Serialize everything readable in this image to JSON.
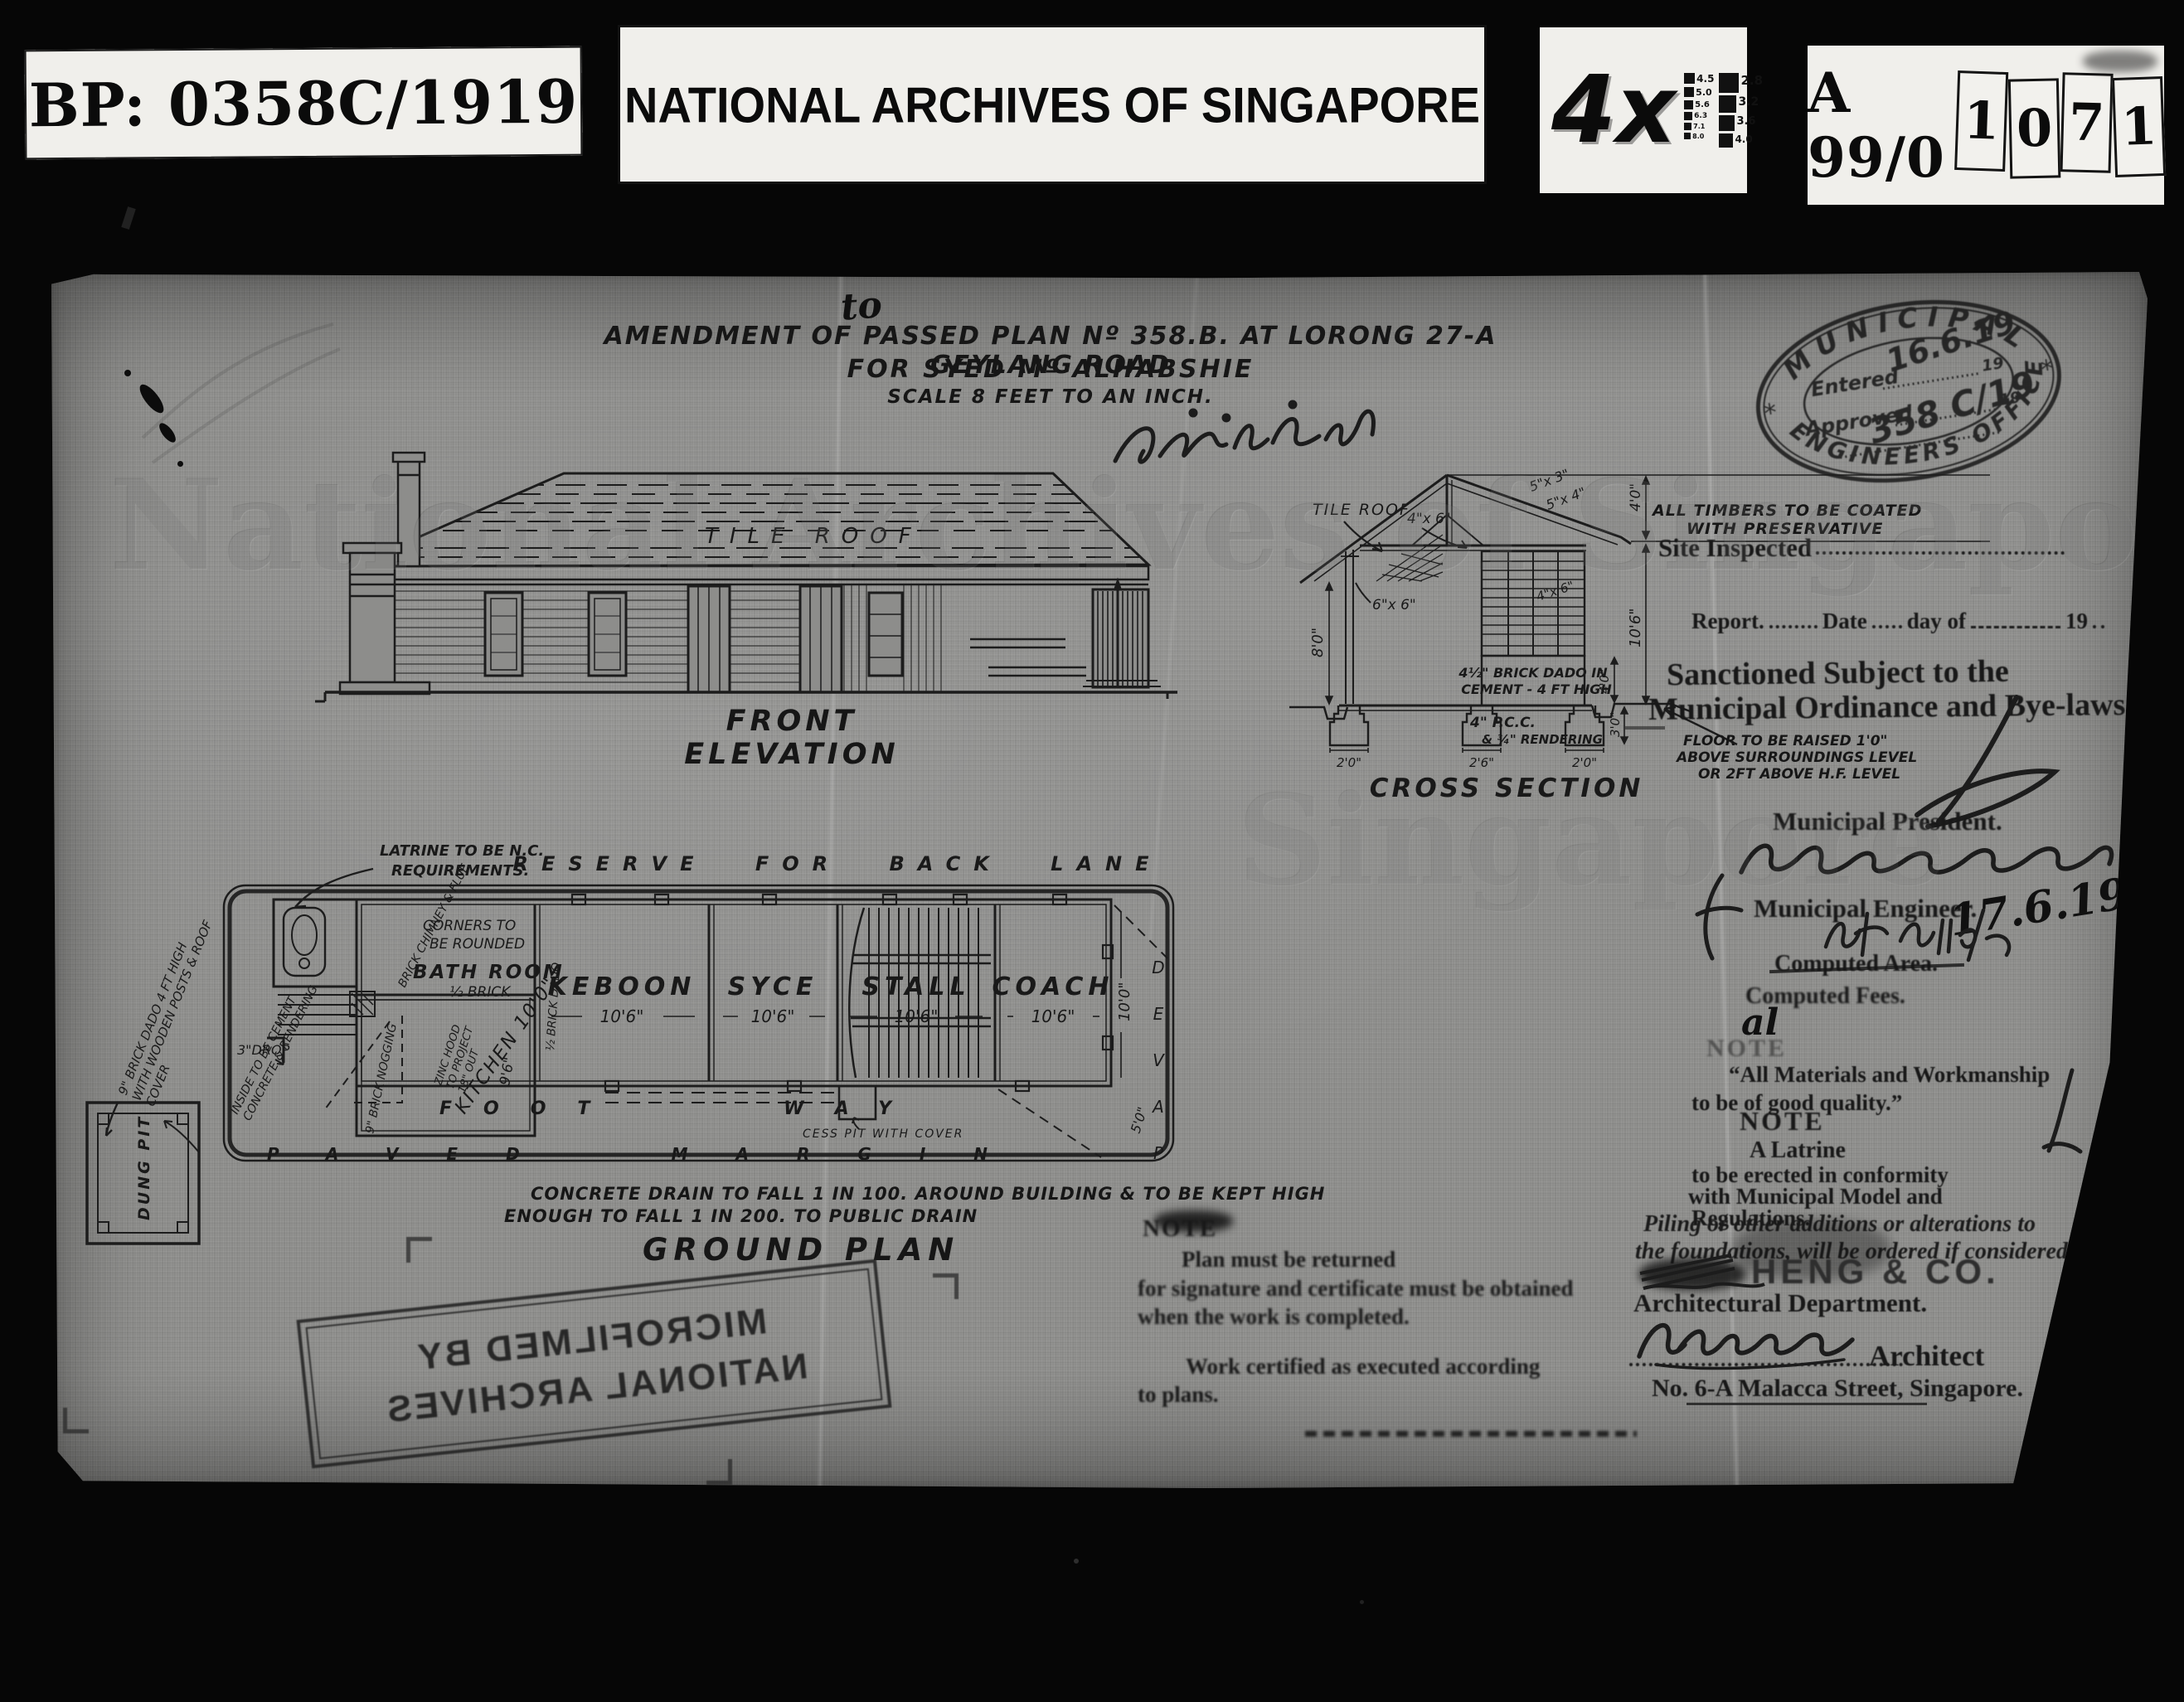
{
  "header": {
    "bp_label": "BP: 0358C/1919",
    "archive_title": "NATIONAL ARCHIVES OF SINGAPORE",
    "magnification": "4x",
    "test_chart_left": [
      "4.5",
      "5.0",
      "5.6",
      "6.3",
      "7.1",
      "8.0"
    ],
    "test_chart_right": [
      "2.8",
      "3.2",
      "3.6",
      "4.0"
    ],
    "reel_prefix": "A 99/0",
    "reel_slip_digits": [
      "1",
      "0",
      "7",
      "1"
    ]
  },
  "plan": {
    "watermark": "National Archives of Singapore",
    "watermark_fragment": "Singapore",
    "correction_word": "to",
    "title_line1": "AMENDMENT OF PASSED PLAN Nº 358.B. AT LORONG 27-A GEYLANG ROAD",
    "title_line2": "FOR SYED Mº ALHABSHIE",
    "title_line3": "SCALE 8 FEET TO AN INCH."
  },
  "front_elevation": {
    "roof_label": "TILE ROOF",
    "caption": "FRONT ELEVATION"
  },
  "cross_section": {
    "caption": "CROSS SECTION",
    "roof_label": "TILE ROOF",
    "dim_5x3": "5\"x 3\"",
    "dim_5x4": "5\"x 4\"",
    "dim_4x6": "4\"x 6\"",
    "dim_4x6_b": "4\"x 6\"",
    "dim_6x6": "6\"x 6\"",
    "dim_left_height": "8'0\"",
    "dim_top": "4'0\"",
    "dim_right_height": "10'6\"",
    "dim_dado": "4'0\"",
    "dim_ground": "3'0\"",
    "footing_dims": [
      "2'0\"",
      "2'6\"",
      "2'0\""
    ],
    "dado_note_1": "4½\" BRICK DADO IN",
    "dado_note_2": "CEMENT - 4 FT HIGH",
    "floor_note_1": "4\" P.C.C.",
    "floor_note_2": "& ¾\" RENDERING"
  },
  "ground_plan": {
    "caption": "GROUND PLAN",
    "reserve_label": "RESERVE FOR BACK LANE",
    "rooms": [
      {
        "name": "KEBOON",
        "dim": "10'6\""
      },
      {
        "name": "SYCE",
        "dim": "10'6\""
      },
      {
        "name": "STALL",
        "dim": "10'6\""
      },
      {
        "name": "COACH",
        "dim": "10'6\""
      }
    ],
    "footway": "FOOT WAY",
    "cesspit_label": "CESS PIT WITH COVER",
    "paved_margin": "PAVED MARGIN",
    "paved_letters": [
      "P",
      "A",
      "V",
      "E",
      "D"
    ],
    "dim_depth": "10'0\"",
    "dim_margin": "5'0\"",
    "latrine_note_1": "LATRINE TO BE N.C.",
    "latrine_note_2": "REQUIREMENTS.",
    "corners_note_1": "CORNERS TO",
    "corners_note_2": "BE ROUNDED",
    "bathroom": "BATH ROOM",
    "half_brick": "½ BRICK",
    "chimney_note": "BRICK CHIMNEY & FLUE",
    "zinc_note_1": "ZINC HOOD",
    "zinc_note_2": "TO PROJECT",
    "zinc_note_3": "18\" OUT",
    "kitchen": "KITCHEN 10'0\"",
    "kitchen_dim": "9'6\"",
    "brick_dado": "½ BRICK DADO",
    "nogging": "9\" BRICK NOGGING",
    "drop": "3\"DROP",
    "dung_pit": "DUNG PIT",
    "dado_cover_1": "9\" BRICK DADO 4 FT HIGH",
    "dado_cover_2": "WITH WOODEN POSTS & ROOF",
    "dado_cover_3": "COVER",
    "inside_note_1": "INSIDE TO BE CEMENT",
    "inside_note_2": "CONCRETE & RENDERING",
    "drain_note_1": "CONCRETE DRAIN TO FALL 1 IN 100. AROUND BUILDING & TO BE KEPT HIGH",
    "drain_note_2": "ENOUGH TO FALL 1 IN 200. TO PUBLIC DRAIN"
  },
  "annotations": {
    "timber_note_1": "ALL TIMBERS TO BE COATED",
    "timber_note_2": "WITH PRESERVATIVE",
    "site_inspected": "Site Inspected",
    "report": "Report.",
    "date_label": "Date",
    "day_of": "day of",
    "year_suffix": "19",
    "sanctioned_1": "Sanctioned Subject to the",
    "sanctioned_2": "Municipal Ordinance and Bye-laws",
    "floor_note_1": "FLOOR TO BE RAISED 1'0\"",
    "floor_note_2": "ABOVE SURROUNDINGS LEVEL",
    "floor_note_3": "OR 2FT ABOVE H.F. LEVEL",
    "municipal_president": "Municipal President.",
    "municipal_engineer": "Municipal Engineer.",
    "engineer_date": "17.6.19",
    "computed_area": "Computed Area.",
    "computed_fees": "Computed Fees.",
    "initials": "al",
    "note_label_1": "NOTE",
    "materials_note_1": "“All Materials and Workmanship",
    "materials_note_2": "to be of good quality.”",
    "note_label_2": "NOTE",
    "latrine_conformity_1": "A Latrine",
    "latrine_conformity_2": "to be erected in conformity",
    "latrine_conformity_3": "with Municipal Model and",
    "latrine_conformity_4": "Regulations.",
    "note_label_3": "NOTE",
    "return_note_1": "Plan must be returned",
    "return_note_2": "for signature and certificate must be obtained",
    "return_note_3": "when the work is completed.",
    "certified_note_1": "Work certified as executed according",
    "certified_note_2": "to plans.",
    "piling_note_1": "Piling or other additions or alterations to",
    "piling_note_2": "the foundations, will be ordered if considered",
    "firm_name": "HENG & CO.",
    "arch_dept": "Architectural Department.",
    "architect_label": "Architect",
    "architect_address": "No. 6-A Malacca Street, Singapore."
  },
  "oval_stamp": {
    "top_text": "MUNICIPAL",
    "bottom_text": "ENGINEERS OFFICE",
    "entered_label": "Entered",
    "entered_hand": "16.6.19",
    "year_1": "19",
    "approved_label": "Approved",
    "year_2": "19",
    "approved_hand": "358 C/19"
  },
  "microfilm_stamp": {
    "line1": "MICROFILMED BY",
    "line2": "NATIONAL ARCHIVES"
  },
  "colors": {
    "page_bg": "#060606",
    "sheet": "#8d8d8b",
    "ink": "#1c1c1c"
  }
}
